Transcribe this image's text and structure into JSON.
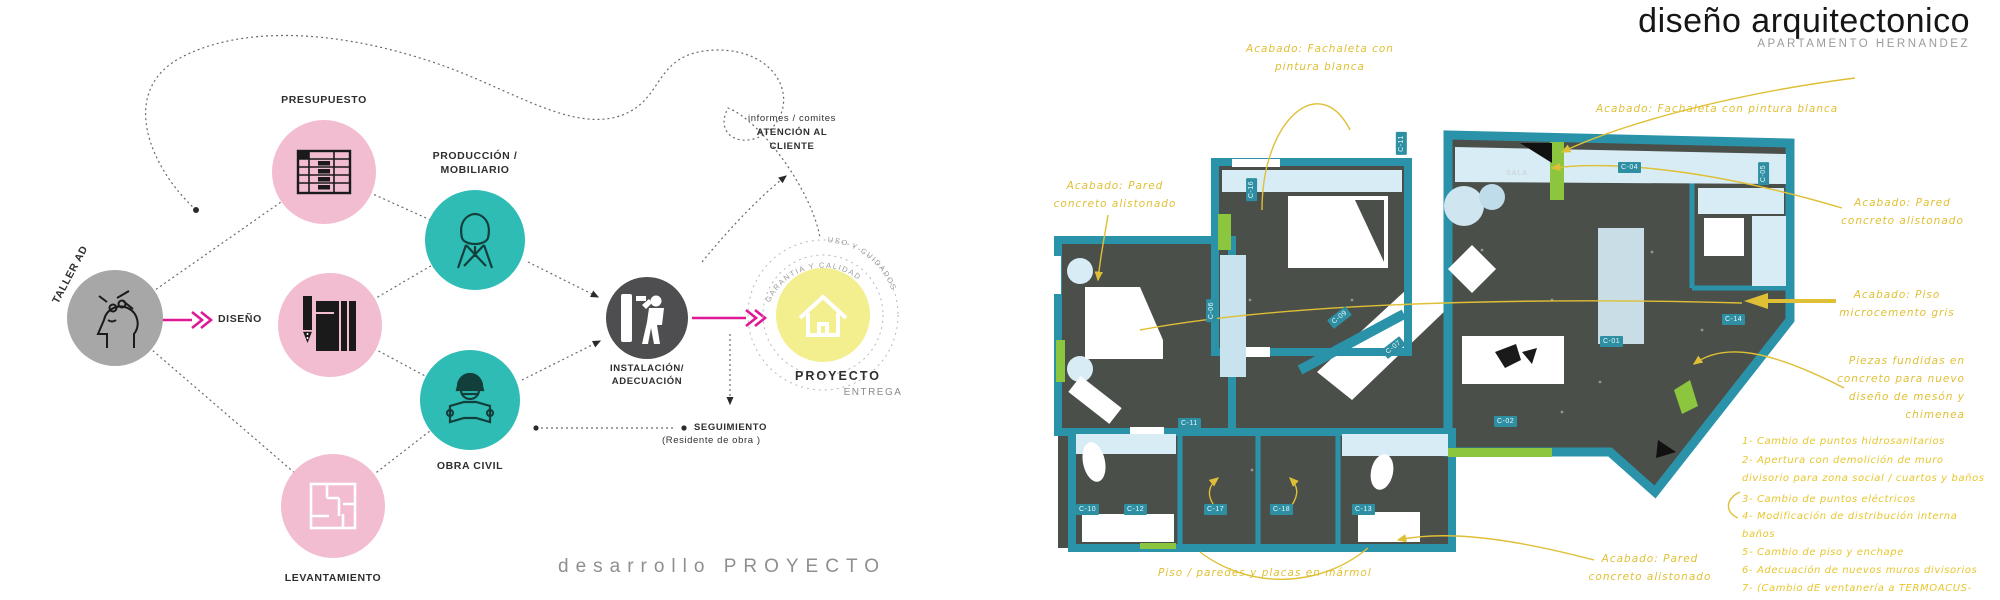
{
  "flow": {
    "taller": "TALLER AD",
    "presupuesto": "PRESUPUESTO",
    "diseno": "DISEÑO",
    "levantamiento": "LEVANTAMIENTO",
    "produccion1": "PRODUCCIÓN /",
    "produccion2": "MOBILIARIO",
    "obra": "OBRA CIVIL",
    "instalacion1": "INSTALACIÓN/",
    "instalacion2": "ADECUACIÓN",
    "proyecto": "PROYECTO",
    "entrega": "ENTREGA",
    "atencion1": "informes / comites",
    "atencion2": "ATENCIÓN AL",
    "atencion3": "CLIENTE",
    "seguimiento": "SEGUIMIENTO",
    "seguimiento_sub": "(Residente de obra )",
    "arc_inner": "GARANTIA Y CALIDAD",
    "arc_outer": "USO Y CUIDADOS",
    "footer": "desarrollo PROYECTO"
  },
  "plan": {
    "title": "diseño arquitectonico",
    "subtitle": "APARTAMENTO HERNANDEZ",
    "sala": "SALA",
    "ann": {
      "fach_top1": "Acabado: Fachaleta con",
      "fach_top2": "pintura blanca",
      "fach_right": "Acabado: Fachaleta con pintura blanca",
      "pared_left1": "Acabado: Pared",
      "pared_left2": "concreto alistonado",
      "pared_right1": "Acabado: Pared",
      "pared_right2": "concreto alistonado",
      "piso1": "Acabado: Piso",
      "piso2": "microcemento gris",
      "piezas1": "Piezas fundidas en",
      "piezas2": "concreto para nuevo",
      "piezas3": "diseño de mesón y",
      "piezas4": "chimenea",
      "marmol": "Piso / paredes y placas en mármol",
      "pared_bottom1": "Acabado: Pared",
      "pared_bottom2": "concreto alistonado"
    },
    "notes": [
      "1- Cambio de puntos hidrosanitarios",
      "2- Apertura con demolición de muro",
      "divisorio para zona social / cuartos y baños",
      "3- Cambio de puntos eléctricos",
      "4- Modificación de distribución interna",
      "baños",
      "5- Cambio de piso y enchape",
      "6- Adecuación de nuevos muros divisorios",
      "7- (Cambio dE ventanería a TERMOACUS-"
    ],
    "codes": [
      "C-04",
      "C-05",
      "C-11",
      "C-16",
      "C-06",
      "C-09",
      "C-07",
      "C-01",
      "C-14",
      "C-02",
      "C-11",
      "C-10",
      "C-12",
      "C-17",
      "C-18",
      "C-13"
    ]
  },
  "colors": {
    "pink": "#f2bcd1",
    "teal": "#2fbcb4",
    "gray_circle": "#a7a7a7",
    "dark_circle": "#4e4e50",
    "yellow_circle": "#f3ee8e",
    "magenta": "#df1995",
    "wall_teal": "#2b93a9",
    "floor_dark": "#4b4f4a",
    "light_blue": "#d8ecf5",
    "lime_green": "#8cc63e",
    "annotation_yellow": "#e0bf34"
  }
}
